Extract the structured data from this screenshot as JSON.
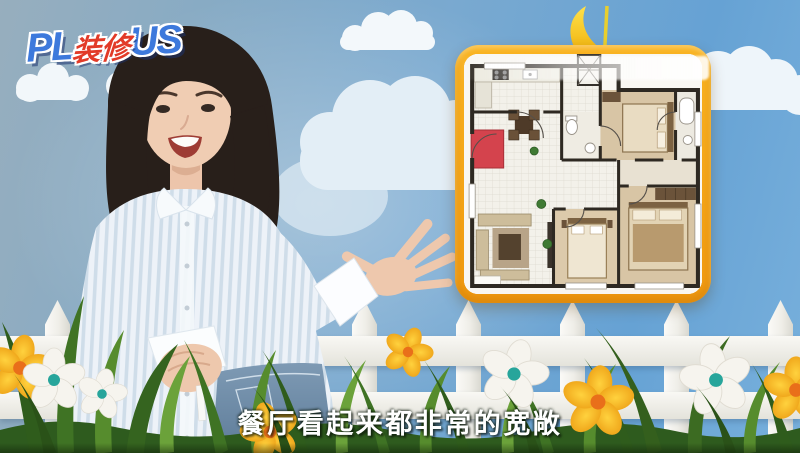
{
  "logo": {
    "prefix": "PL",
    "badge": "装修",
    "suffix": "US"
  },
  "subtitle": {
    "text": "餐厅看起来都非常的宽敞"
  },
  "colors": {
    "frame_orange": "#F2A014",
    "logo_blue": "#3D79DC",
    "logo_red": "#E23A28",
    "subtitle_white": "#FFFFFF",
    "sky_blue": "#6FA6D6",
    "fence_white": "#F2F1EC",
    "grass_green": "#568C2D",
    "flower_yellow": "#F6B92B",
    "flower_center_orange": "#E96F1A",
    "flower_white": "#F6F4EE",
    "flower_center_teal": "#27A59B",
    "floor_plan_rug_red": "#D4434D"
  },
  "icon_names": [
    "cloud-icon",
    "picket-fence",
    "daisy-flower-icon",
    "grass",
    "floor-plan",
    "swoosh-arrow-icon"
  ]
}
